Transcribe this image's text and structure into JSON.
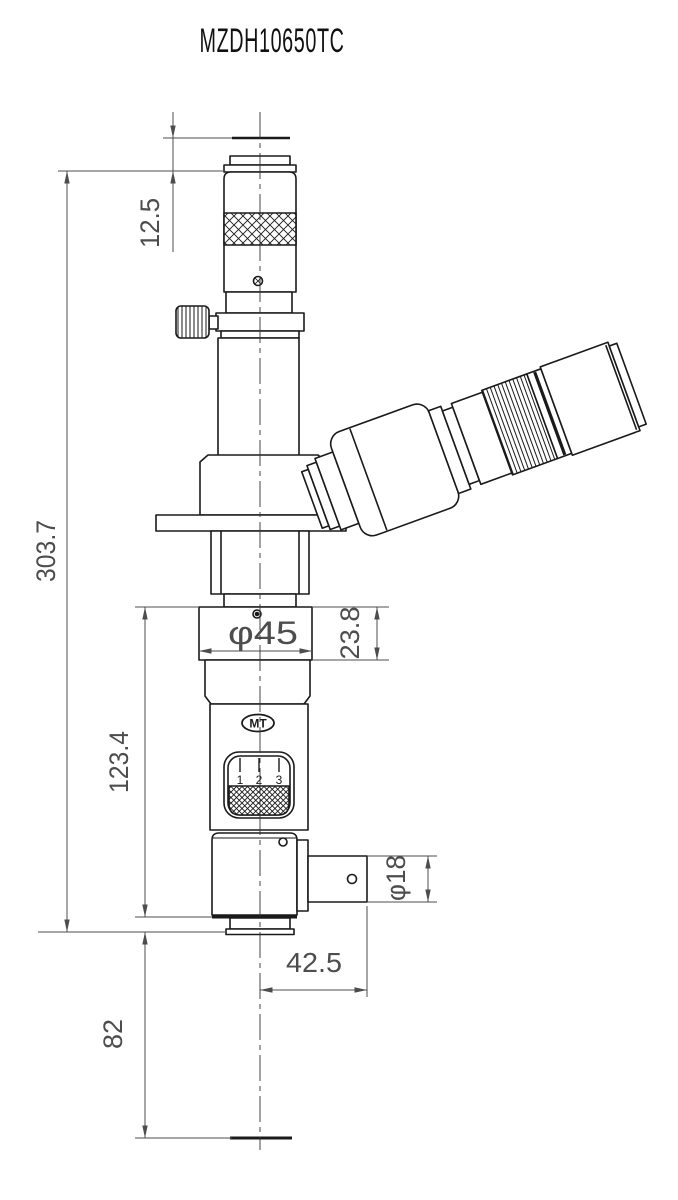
{
  "title": "MZDH10650TC",
  "logo_text": "MT",
  "dial_ticks": [
    "1",
    "2",
    "3"
  ],
  "dimensions": {
    "eyepoint_height": "12.5",
    "overall_height": "303.7",
    "lower_body_height": "123.4",
    "working_distance": "82",
    "mount_diameter": "φ45",
    "mount_height": "23.8",
    "port_diameter": "φ18",
    "port_length": "42.5"
  },
  "colors": {
    "background": "#ffffff",
    "object_line": "#1a1a1a",
    "dimension_line": "#4d4d4d"
  }
}
